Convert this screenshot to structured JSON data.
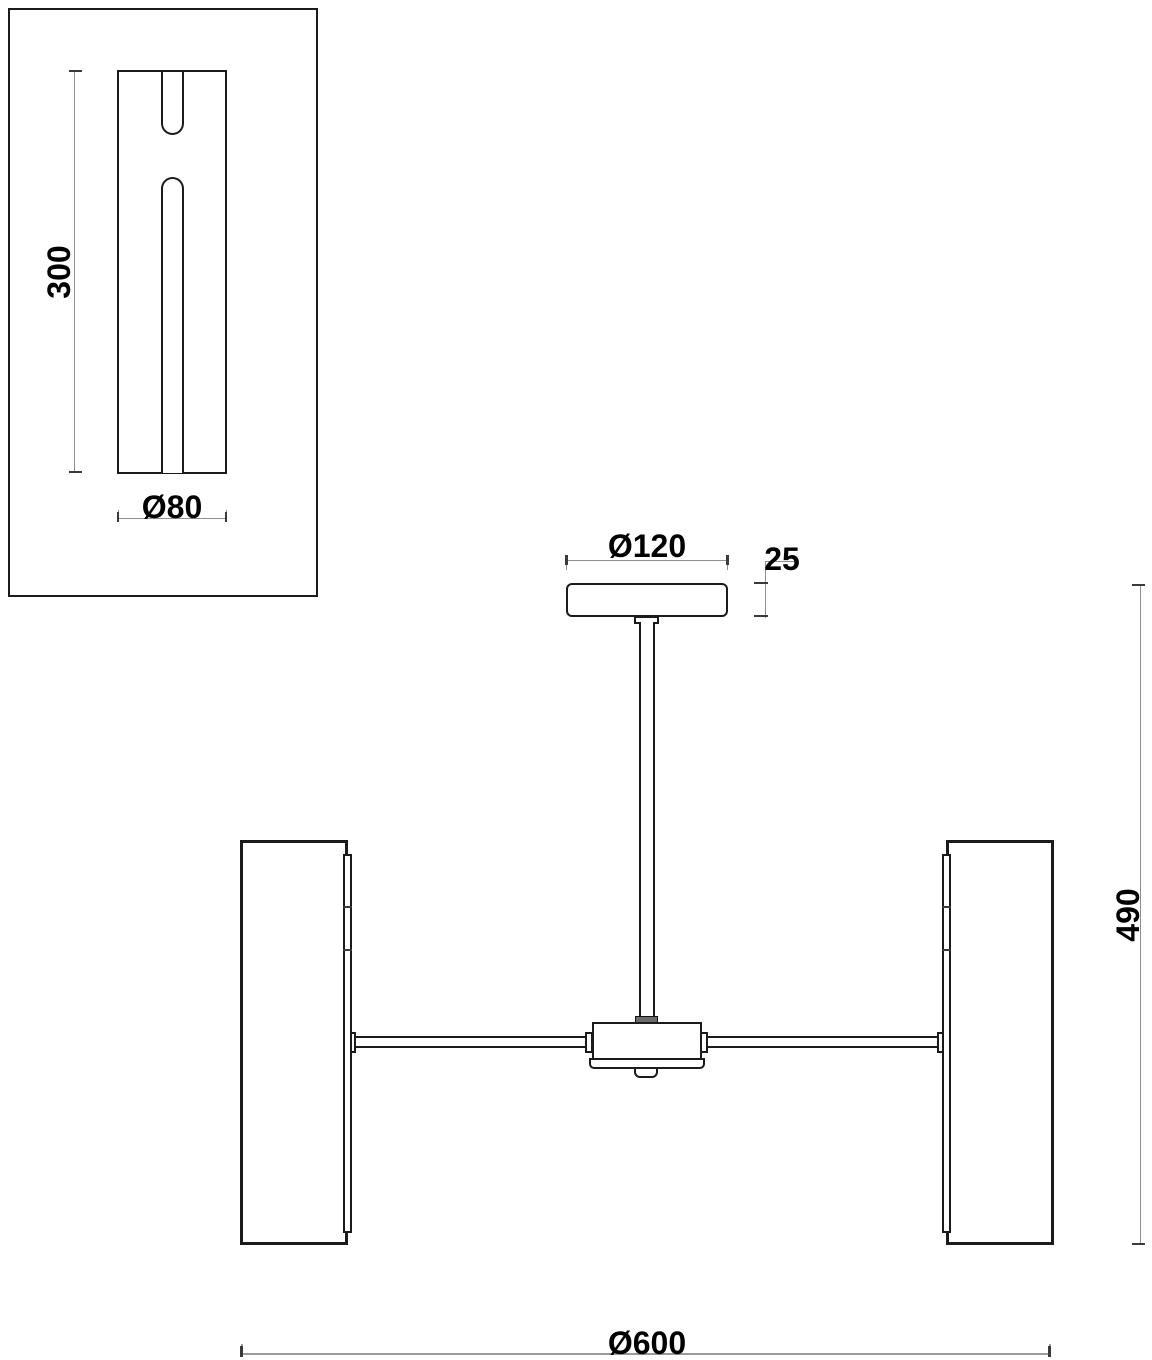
{
  "drawing": {
    "type": "technical dimension drawing of a ceiling lamp",
    "detail_view": {
      "length_label": "300",
      "diameter_label": "Ø80"
    },
    "main_view": {
      "canopy_diameter_label": "Ø120",
      "canopy_height_label": "25",
      "overall_height_label": "490",
      "overall_diameter_label": "Ø600"
    }
  },
  "colors": {
    "object_line": "#1b1b1b",
    "dimension_line": "#8f8f8f",
    "text": "#000000",
    "background": "#ffffff"
  }
}
